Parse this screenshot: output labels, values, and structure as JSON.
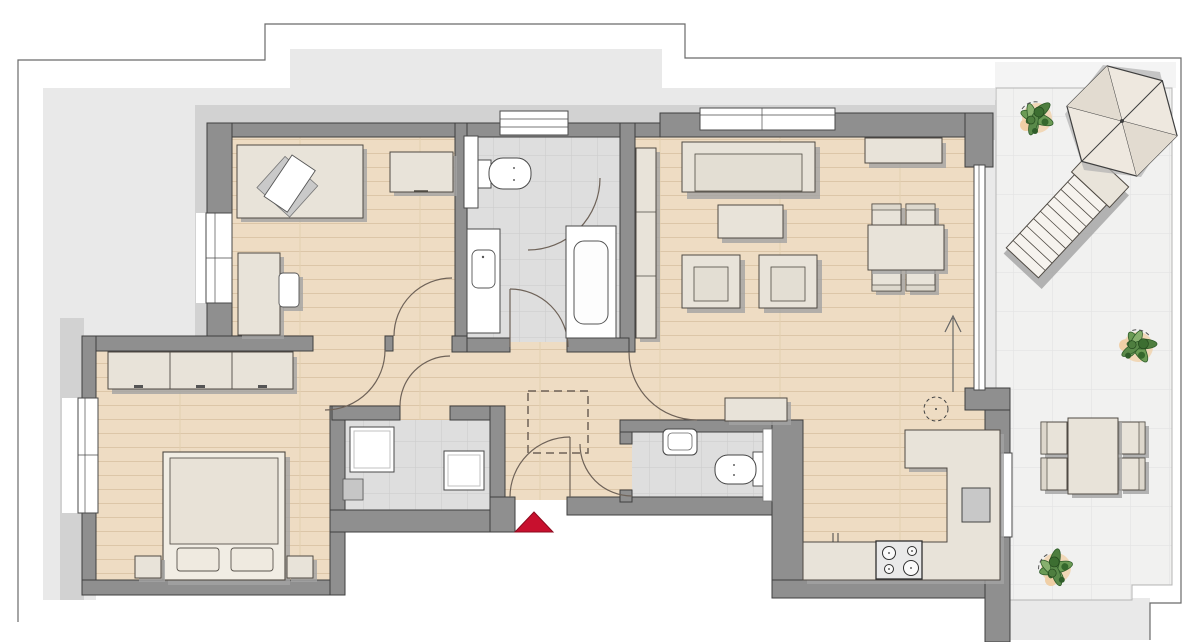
{
  "title": "apartment-floor-plan-with-roof-terrace",
  "colors": {
    "page_bg": "#ffffff",
    "roof_light": "#e9e9e9",
    "roof_mid": "#d2d2d2",
    "wall_fill": "#8f8f8f",
    "wall_stroke": "#3f3f3f",
    "wood_base": "#eedcc3",
    "wood_line": "#dcc6a8",
    "tile_base": "#dedede",
    "tile_line": "#cbcbcb",
    "terrace_tile": "#f1f1f0",
    "terrace_line": "#e3e3e3",
    "furniture_fill": "#e8e3d9",
    "furniture_stroke": "#4f4a43",
    "furniture_shadow": "#a3a3a3",
    "fixture_white": "#ffffff",
    "accent_red": "#c8102e",
    "plant_green": "#4e7e3f",
    "plant_green_light": "#87b06e",
    "plant_accent": "#f0cfa6",
    "door_arc": "#6e6258",
    "outline": "#6a6a6a"
  },
  "plan": {
    "rooms": [
      "office",
      "bathroom",
      "living-dining-room",
      "hallway",
      "bedroom",
      "utility-room",
      "guest-wc",
      "kitchen",
      "roof-terrace"
    ],
    "furniture": {
      "office": [
        "desk",
        "office-chair",
        "cabinet",
        "side-desk",
        "side-chair"
      ],
      "bathroom": [
        "toilet",
        "washbasin-counter",
        "bathtub"
      ],
      "living_dining": [
        "sofa",
        "coffee-table",
        "armchair",
        "armchair",
        "sideboard",
        "dining-table",
        "dining-chairs-4",
        "tall-cabinet"
      ],
      "hallway": [
        "console-cabinet",
        "dashed-reserved-area"
      ],
      "bedroom": [
        "wardrobe-3-door",
        "double-bed",
        "nightstand",
        "nightstand"
      ],
      "utility_room": [
        "washing-machine",
        "dryer"
      ],
      "guest_wc": [
        "washbasin",
        "toilet"
      ],
      "kitchen": [
        "l-shaped-counter",
        "cooktop-4-burners",
        "sink",
        "dashed-circle-fixture"
      ],
      "roof_terrace": [
        "parasol",
        "sun-lounger",
        "outdoor-table",
        "outdoor-chairs-4",
        "potted-plant",
        "potted-plant",
        "potted-plant"
      ]
    },
    "markers": {
      "entrance": "red-triangle",
      "orientation": "up-arrow",
      "window_count": 6,
      "door_swing_count": 8,
      "plant_count": 3
    }
  }
}
